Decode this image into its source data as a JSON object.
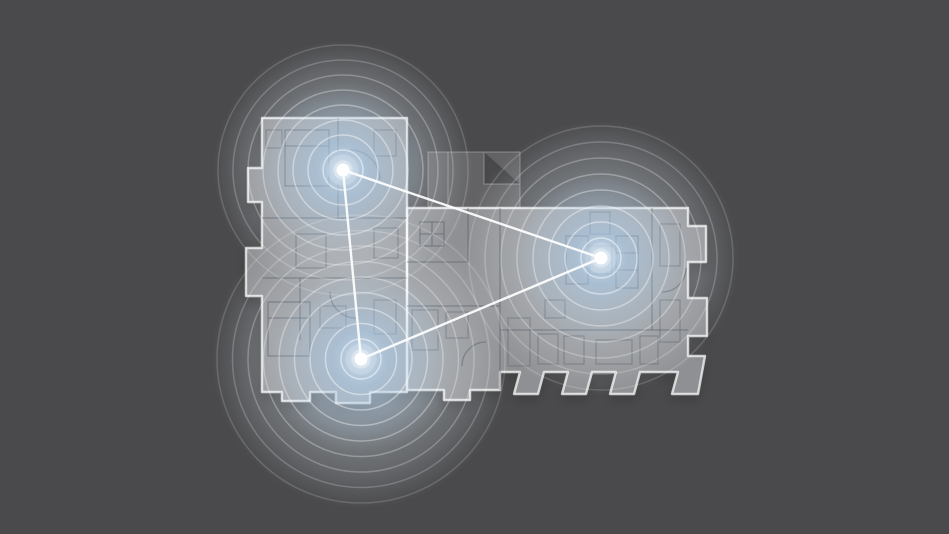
{
  "scene": {
    "description": "Mesh WiFi coverage illustration over apartment floor plan",
    "canvas": {
      "width": 949,
      "height": 534
    },
    "background_color": "#4a4a4c",
    "colors": {
      "background": "#4a4a4c",
      "outer_glow": "#c7d1d8",
      "blue_glow_core": "#cfe1f2",
      "blue_glow_mid": "#a6c6e4",
      "ripple": "#ffffff",
      "link_line": "#ffffff",
      "node_dot": "#ffffff",
      "plan_fill": "#eef1f4",
      "plan_wall": "#46505c"
    },
    "nodes": [
      {
        "id": "node-top-left",
        "x": 343,
        "y": 170,
        "glow_radius": 130,
        "blue_radius": 88,
        "ripples": {
          "count": 8,
          "start": 20,
          "spacing": 15
        }
      },
      {
        "id": "node-bottom-left",
        "x": 361,
        "y": 359,
        "glow_radius": 150,
        "blue_radius": 94,
        "ripples": {
          "count": 9,
          "start": 20,
          "spacing": 15.5
        }
      },
      {
        "id": "node-right",
        "x": 601,
        "y": 258,
        "glow_radius": 138,
        "blue_radius": 88,
        "ripples": {
          "count": 8,
          "start": 20,
          "spacing": 16
        }
      }
    ],
    "connections": [
      [
        "node-top-left",
        "node-bottom-left"
      ],
      [
        "node-top-left",
        "node-right"
      ],
      [
        "node-bottom-left",
        "node-right"
      ]
    ],
    "node_dot_radius": 6.5,
    "link_width": 2.4,
    "ripple_width": 1.5,
    "ripple_opacity_inner": 0.5,
    "ripple_opacity_outer": 0.16
  }
}
